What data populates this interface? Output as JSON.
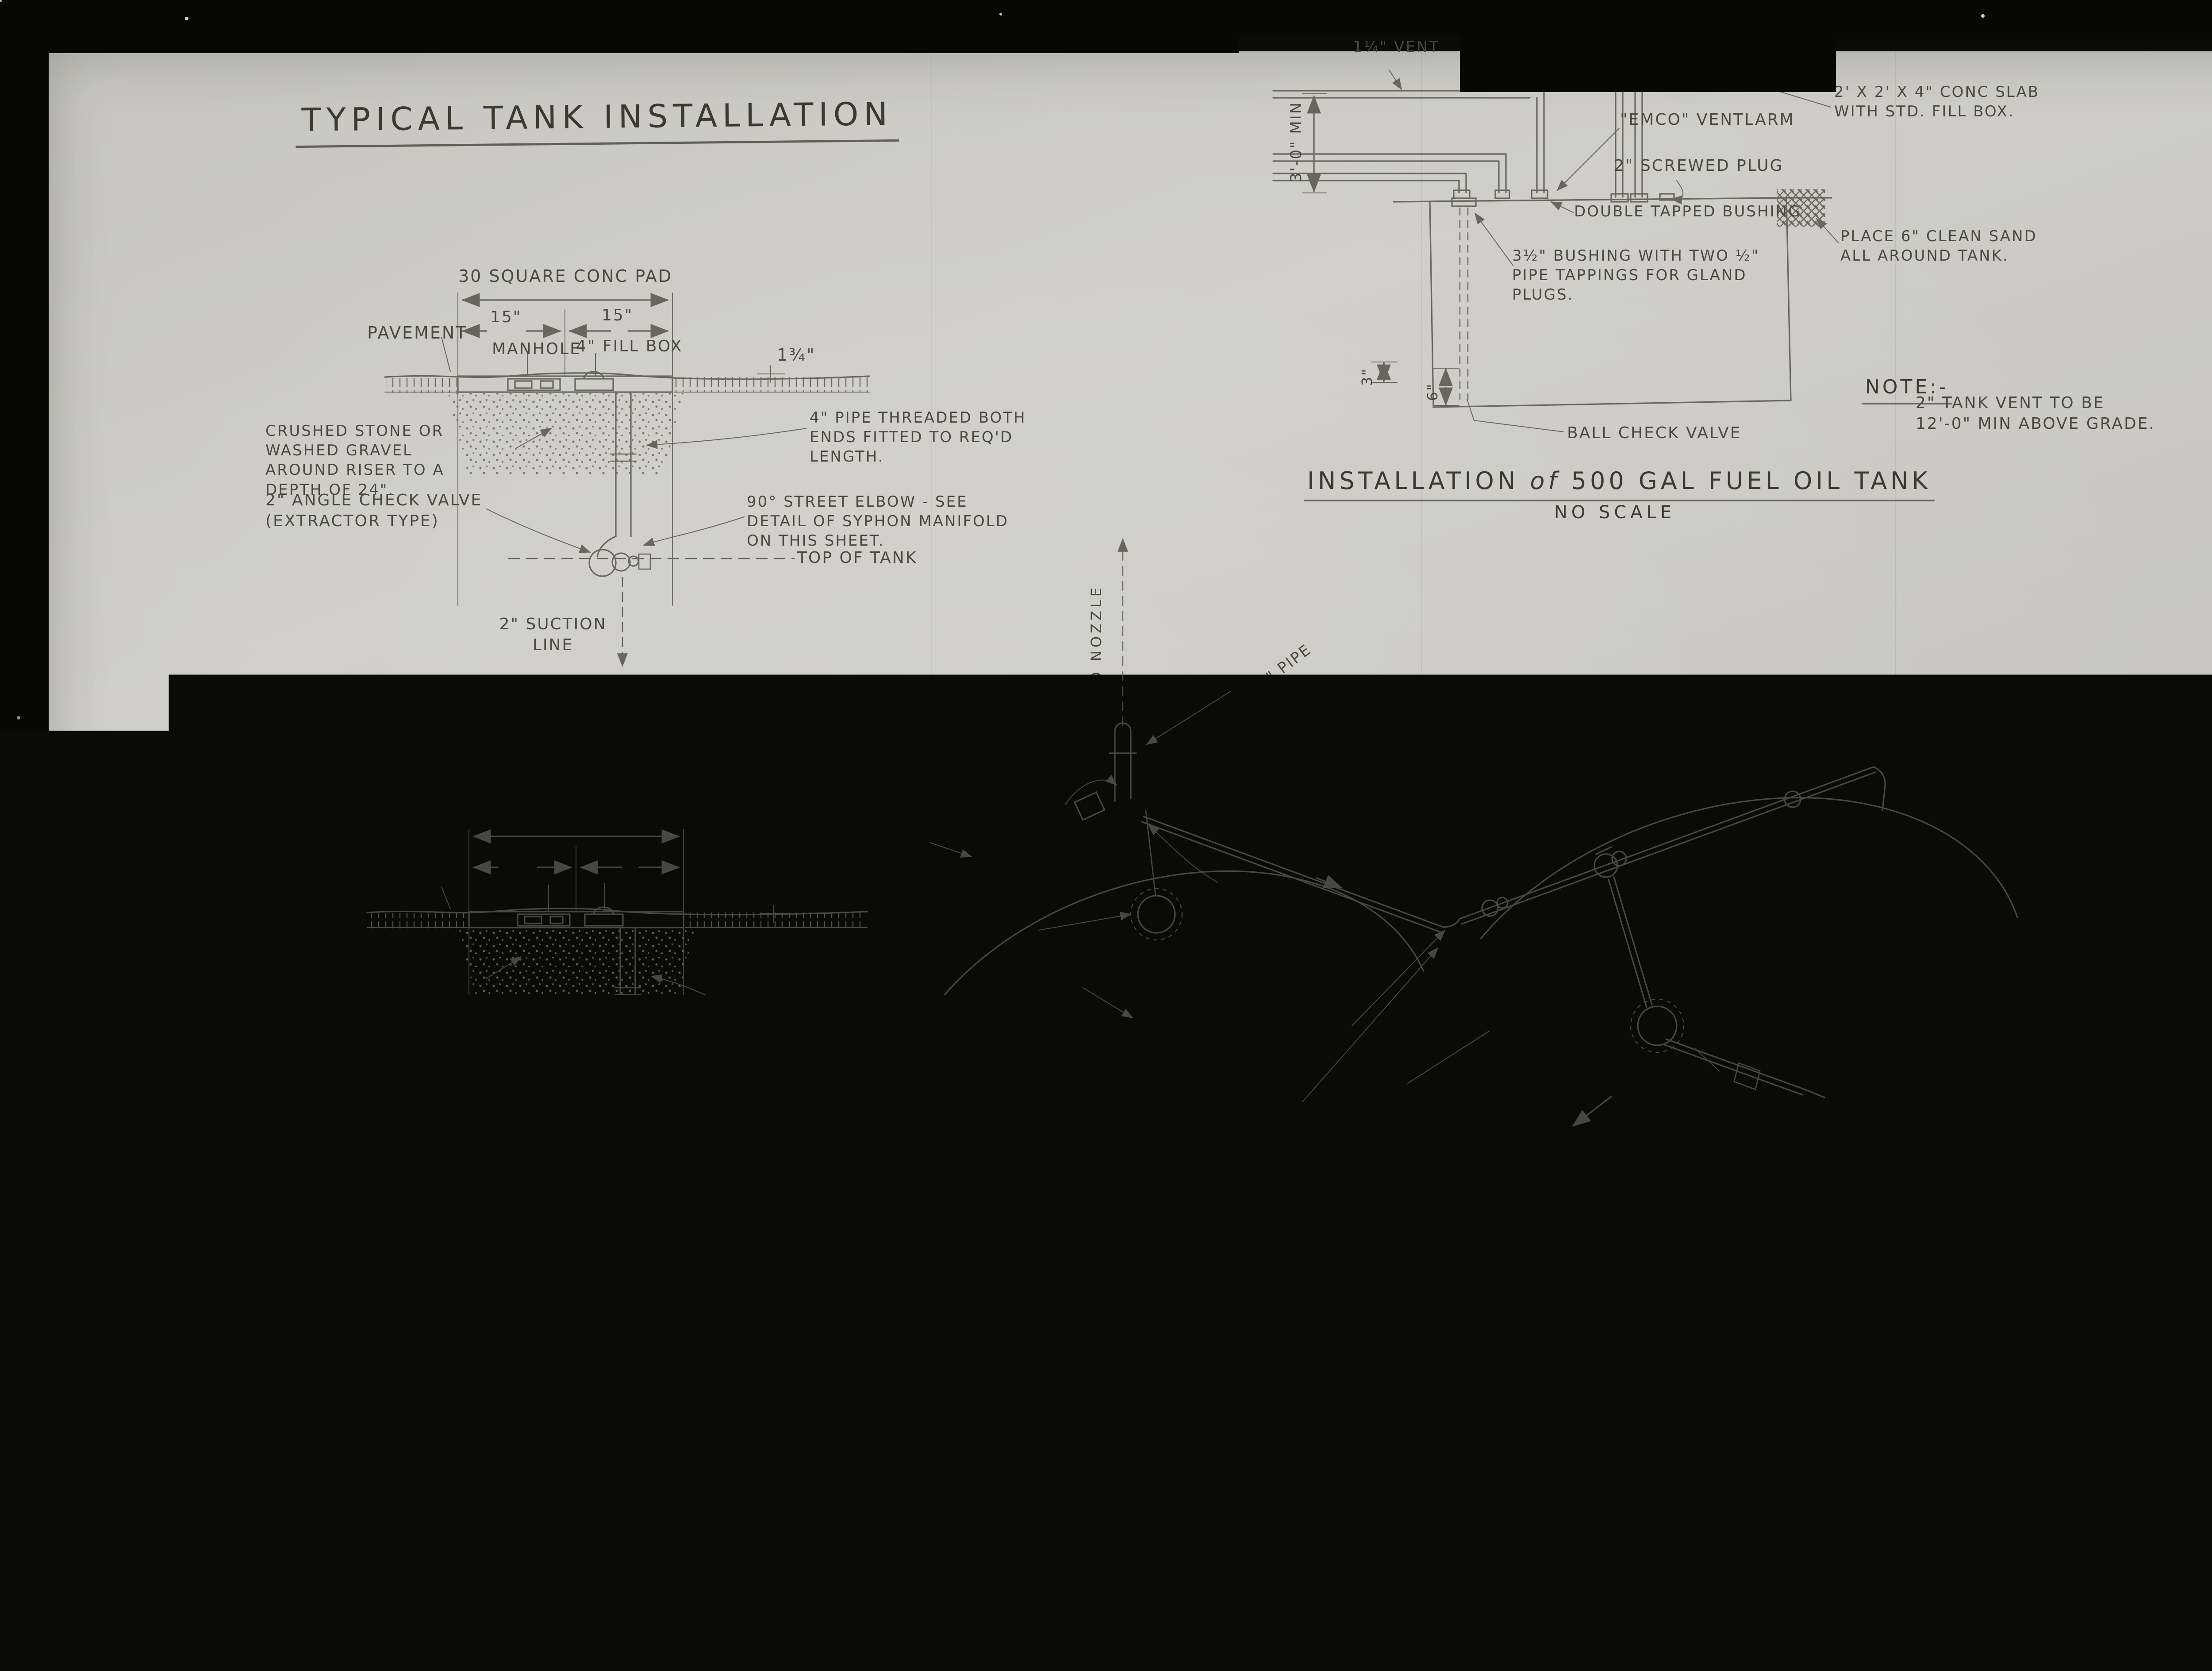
{
  "photo": {
    "page_label": "3 of/de",
    "drawing_number": "S.D.B. 10011 12-47",
    "stamp_line1": "MAR",
    "stamp_line2": "19"
  },
  "left": {
    "title": "TYPICAL TANK INSTALLATION",
    "d1": {
      "pad": "30 SQUARE CONC PAD",
      "dim15a": "15\"",
      "dim15b": "15\"",
      "pavement": "PAVEMENT",
      "manhole": "MANHOLE",
      "fillbox": "4\" FILL BOX",
      "thk": "1¾\"",
      "gravel": "CRUSHED STONE OR\nWASHED GRAVEL\nAROUND RISER TO A\nDEPTH OF 24\".",
      "valve": "2\" ANGLE CHECK VALVE\n(EXTRACTOR TYPE)",
      "pipe": "4\" PIPE THREADED BOTH\nENDS FITTED TO REQ'D\nLENGTH.",
      "elbow": "90° STREET ELBOW - SEE\nDETAIL OF SYPHON MANIFOLD\nON THIS SHEET.",
      "top_of_tank": "TOP OF TANK",
      "suction": "2\" SUCTION\nLINE",
      "h1": "ANGLE CHECK VALVE - NO",
      "h2": "SYPHON CONNECTION"
    },
    "d2": {
      "pad": "30\" SQUARE CONC PAD",
      "dim15a": "15\"",
      "dim15b": "15\"",
      "pavement": "PAVEMENT",
      "manhole": "MANHOLE",
      "fillcap": "4\" FILL CAP",
      "thk": "1¾\"",
      "gravel": "CRUSHED STONE OR\nWASHED GRAVEL\nAROUND RISER TO\nA DEPTH OF 24\"",
      "valve": "2\" ANGLE CHECK VALVE\n(EXTRACTOR TYPE)",
      "pipe": "4\" PIPE THREADED BOTH\nENDS FITTED TO REQ'D\nLENGTH.",
      "elbow": "90° STREET ELBOW - SEE\nDETAIL OF SYPHON MANIFOLD\nON THIS SHEET.",
      "syphon": "2\" SYPHON LINE\nTO ADJACENT TANK",
      "top_of_tank": "TOP OF TANK",
      "suction": "2\" SUCTION LINE",
      "h1": "ANGLE CHECK VALVE WITH",
      "h2": "SYPHON CONNECTION"
    },
    "main_title1": "INSTALLATION DETAILS FOR EXTRACTABLE",
    "main_title2": "ANGLE CHECK VALVE",
    "main_scale": "NO SCALE"
  },
  "tank": {
    "vent": "1¼\" VENT",
    "dim_h": "3'-0\" MIN",
    "ventalarm": "\"EMCO\" VENTLARM",
    "plug": "2\" SCREWED PLUG",
    "slab": "2' X 2' X 4\" CONC SLAB\nWITH STD. FILL BOX.",
    "bushing_double": "DOUBLE TAPPED BUSHING",
    "sand": "PLACE 6\" CLEAN SAND\nALL AROUND TANK.",
    "bushing_gland": "3½\" BUSHING WITH TWO ½\"\nPIPE TAPPINGS FOR GLAND\nPLUGS.",
    "dim3": "3\"",
    "dim6": "6\"",
    "ball": "BALL CHECK VALVE",
    "note_h": "NOTE:-",
    "note": "2\" TANK VENT TO BE\n12'-0\" MIN ABOVE GRADE.",
    "title_pre": "INSTALLATION",
    "title_of": "of",
    "title_post": "500 GAL FUEL OIL TANK",
    "scale": "NO SCALE"
  },
  "manifold": {
    "to_nozzle": "TO NOZZLE",
    "pipe34": "3\" OR 4\" PIPE",
    "acv_ext": "2\" ANGLE CHECK VALVE - EXTRACTABLE",
    "elbows_l": "2-90° STR\nELBOWS",
    "union1": "UNION",
    "elbows_r": "2-90° STR. ELBOWS",
    "syphon": "2\"Ø SYPHON LINE",
    "pump1": "TO PUMP\nISLAND",
    "male": "3½\" MALE THRD\nINTO TANK FLANGE",
    "slope": "SLOPE ¼\" PER FOOT",
    "down": "DOWN",
    "pipe2a": "2\"Ø PIPE",
    "union2": "UNION",
    "nipple1": "NIPPLE",
    "elbows90": "90° STR ELBOW'S",
    "acv2": "2\" ANGLE CHECK\nVALVE",
    "elbow90b": "90° STR ELBOW",
    "union3": "UNION",
    "elbow_mid": "90° STR ELBOW",
    "bushing": "3½\" x 2\" DOUBLE\nTAPPED BUSHING",
    "pipe2b": "2\"Ø PIPE",
    "pump2": "TO PUMP ISLAND",
    "pipe15": "1½\"Ø PIPE:",
    "reducer": "2\" x 1½\" REDUCER-",
    "nipple2": "NIPPLE",
    "title_pre": "DETAIL",
    "title_of": "of",
    "title_post": "TYPICAL SYPHON MANIFOLD",
    "scale": "NO SCALE",
    "notes_h": "NOTES:-",
    "notes": "ALL FITTINGS TO BE SCREWED GALV.\nMALLEABLE IRON."
  },
  "notes": {
    "heading": "NOTE:-",
    "items": [
      {
        "num": "1.",
        "rev": "",
        "text": "FOR TYPES & CATALOG NUMBERS\nOF VALVES, FILL BOXES, MANHOLES\nETC. - REFER TO APPROVAL LIST.\nREFER TO LAYOUT FOR TYPE OF\nGASOLINE PIPING TO BE USED."
      },
      {
        "num": "2.",
        "rev": "9",
        "text": "ADDITIONAL STREET ELLS TO BE INSTALLED\nWHERE CONSIDERED NECESSARY AND WHERE\nSLOPE & ORIENTATION OF PIPING MAKE IT\nPRACTICAL."
      },
      {
        "num": "3.",
        "rev": "9",
        "text": "TWO FILL PIPES PER TANK SHALL BE\nINSTALLED WHEN INDICATED ON LAYOUT\nDRAWING AND/OR INCLUDED IN ADDENDA\nTO SPECIFICATIONS."
      },
      {
        "num": "4.",
        "rev": "9",
        "text1": "BOTTOM OF TANKS TO BE AT SAME",
        "text2a": "ELEVATION ",
        "text2b": "REGARDLESS",
        "text2c": " OF TANK SIZE"
      }
    ]
  },
  "right": {
    "marker": "A",
    "frag1": "EXTRA",
    "frag2": "ANGLE",
    "frag3": "VALVE",
    "elbow1": "90° ELBOW",
    "elbow2": "90° ELBOW",
    "street": "STREET\nELBOW"
  }
}
